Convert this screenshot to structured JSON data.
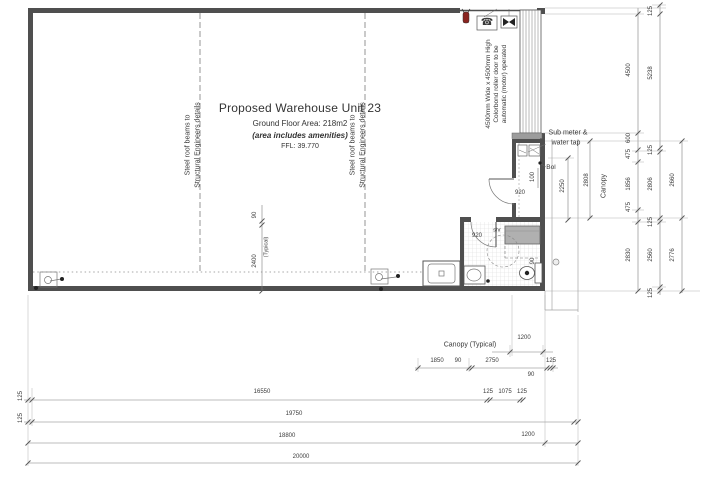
{
  "plan_text": {
    "title": "Proposed Warehouse Unit 23",
    "area": "Ground Floor Area: 218m2",
    "area_note": "(area includes amenities)",
    "ffl": "FFL: 39.770"
  },
  "colors": {
    "wall": "#4f4f4f",
    "dim_line": "#7f7f7f",
    "dim_text": "#3b3b3b",
    "tile_grid": "#dcdcdc",
    "shower_tray": "#b0b0b0",
    "threshold": "#9c9c9c",
    "extinguisher_red": "#8a2420",
    "background": "#ffffff"
  },
  "icons": {
    "fire_extinguisher": "fire-extinguisher-icon",
    "phone": "phone-icon",
    "roller_door_motor": "roller-door-motor-icon",
    "floor_waste": "floor-waste-icon",
    "bollard_dot": "bollard-icon"
  },
  "labels": [
    {
      "text": "125",
      "x": 651,
      "y": 11,
      "rot": 1
    },
    {
      "text": "4500",
      "x": 629,
      "y": 70,
      "rot": 1
    },
    {
      "text": "5238",
      "x": 651,
      "y": 73,
      "rot": 1
    },
    {
      "text": "600",
      "x": 629,
      "y": 138,
      "rot": 1
    },
    {
      "text": "475",
      "x": 629,
      "y": 154,
      "rot": 1
    },
    {
      "text": "125",
      "x": 651,
      "y": 150,
      "rot": 1
    },
    {
      "text": "1856",
      "x": 629,
      "y": 184,
      "rot": 1
    },
    {
      "text": "2806",
      "x": 651,
      "y": 184,
      "rot": 1
    },
    {
      "text": "2660",
      "x": 673,
      "y": 180,
      "rot": 1
    },
    {
      "text": "475",
      "x": 629,
      "y": 207,
      "rot": 1
    },
    {
      "text": "125",
      "x": 651,
      "y": 222,
      "rot": 1
    },
    {
      "text": "2830",
      "x": 629,
      "y": 255,
      "rot": 1
    },
    {
      "text": "2560",
      "x": 651,
      "y": 255,
      "rot": 1
    },
    {
      "text": "2776",
      "x": 673,
      "y": 255,
      "rot": 1
    },
    {
      "text": "125",
      "x": 651,
      "y": 293,
      "rot": 1
    },
    {
      "text": "100",
      "x": 533,
      "y": 177,
      "rot": 1
    },
    {
      "text": "2250",
      "x": 563,
      "y": 186,
      "rot": 1
    },
    {
      "text": "2808",
      "x": 587,
      "y": 180,
      "rot": 1
    },
    {
      "text": "90",
      "x": 533,
      "y": 261,
      "rot": 1
    },
    {
      "text": "Canopy",
      "x": 604,
      "y": 186,
      "rot": 1,
      "size": 7,
      "name": "canopy-side-label"
    },
    {
      "text": "90",
      "x": 255,
      "y": 215,
      "rot": 1
    },
    {
      "text": "2400",
      "x": 255,
      "y": 261,
      "rot": 1
    },
    {
      "text": "(Typical)",
      "x": 267,
      "y": 247,
      "rot": 1,
      "size": 5.5
    },
    {
      "text": "920",
      "x": 520,
      "y": 193,
      "name": "door-width-label"
    },
    {
      "text": "920",
      "x": 477,
      "y": 236,
      "name": "door-width-label"
    },
    {
      "text": "Bol",
      "x": 551,
      "y": 168,
      "size": 6.5,
      "name": "bollard-label"
    },
    {
      "text": "shr",
      "x": 497,
      "y": 231,
      "size": 5.5,
      "name": "shower-label"
    },
    {
      "text": "Sub meter &",
      "x": 568,
      "y": 133,
      "size": 7,
      "name": "submeter-label"
    },
    {
      "text": "water tap",
      "x": 566,
      "y": 143,
      "size": 7,
      "name": "submeter-label"
    },
    {
      "text": "4500mm Wide x 4500mm High",
      "x": 489,
      "y": 84,
      "rot": 1,
      "size": 6.5,
      "name": "roller-door-note"
    },
    {
      "text": "Colorbond roller door to be",
      "x": 497,
      "y": 84,
      "rot": 1,
      "size": 6.5,
      "name": "roller-door-note"
    },
    {
      "text": "automatic (motor) operated",
      "x": 505,
      "y": 84,
      "rot": 1,
      "size": 6.5,
      "name": "roller-door-note"
    },
    {
      "text": "Steel roof beams to",
      "x": 188,
      "y": 145,
      "rot": 1,
      "size": 7,
      "name": "beam-note"
    },
    {
      "text": "Structural Engineers details",
      "x": 198,
      "y": 145,
      "rot": 1,
      "size": 7,
      "name": "beam-note"
    },
    {
      "text": "Steel roof beams to",
      "x": 353,
      "y": 145,
      "rot": 1,
      "size": 7,
      "name": "beam-note"
    },
    {
      "text": "Structural Engineers details",
      "x": 363,
      "y": 145,
      "rot": 1,
      "size": 7,
      "name": "beam-note"
    },
    {
      "text": "Canopy (Typical)",
      "x": 470,
      "y": 345,
      "size": 7,
      "name": "canopy-bottom-label"
    },
    {
      "text": "1200",
      "x": 524,
      "y": 338
    },
    {
      "text": "1850",
      "x": 437,
      "y": 361
    },
    {
      "text": "90",
      "x": 458,
      "y": 361
    },
    {
      "text": "2750",
      "x": 492,
      "y": 361
    },
    {
      "text": "90",
      "x": 531,
      "y": 375
    },
    {
      "text": "125",
      "x": 551,
      "y": 361
    },
    {
      "text": "125",
      "x": 21,
      "y": 396,
      "rot": 1
    },
    {
      "text": "16550",
      "x": 262,
      "y": 392
    },
    {
      "text": "125",
      "x": 488,
      "y": 392
    },
    {
      "text": "1075",
      "x": 505,
      "y": 392
    },
    {
      "text": "125",
      "x": 522,
      "y": 392
    },
    {
      "text": "125",
      "x": 21,
      "y": 418,
      "rot": 1
    },
    {
      "text": "19750",
      "x": 294,
      "y": 414
    },
    {
      "text": "18800",
      "x": 287,
      "y": 436
    },
    {
      "text": "1200",
      "x": 528,
      "y": 435
    },
    {
      "text": "20000",
      "x": 301,
      "y": 457
    },
    {
      "text": "☎",
      "x": 487,
      "y": 23,
      "size": 10,
      "name": "phone-icon-glyph"
    }
  ]
}
